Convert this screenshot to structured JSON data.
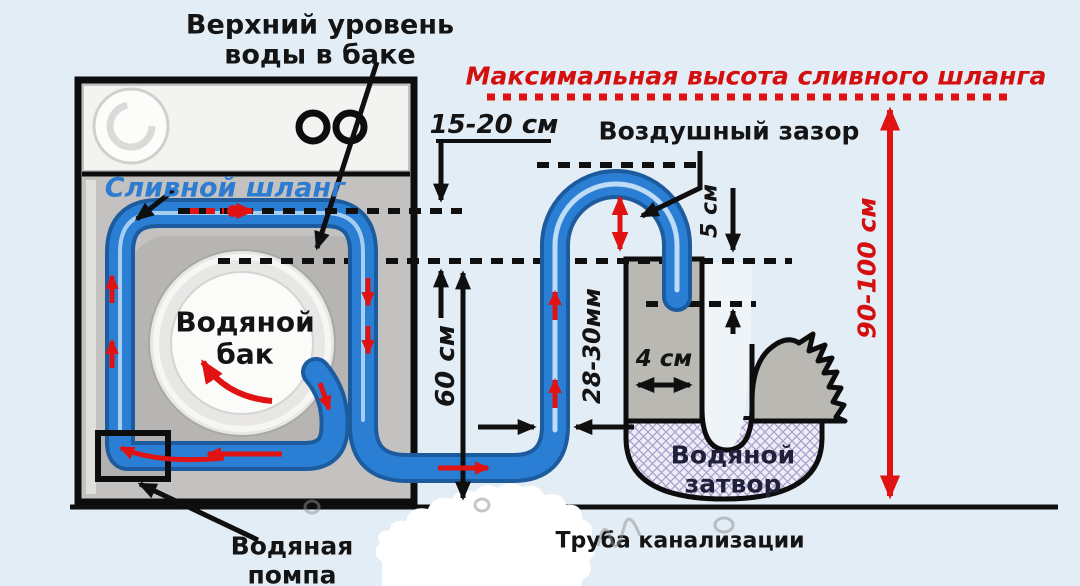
{
  "labels": {
    "upper_water_level": {
      "line1": "Верхний уровень",
      "line2": "воды в баке"
    },
    "max_drain_height": "Максимальная высота сливного шланга",
    "air_gap": "Воздушный зазор",
    "drain_hose": "Сливной шланг",
    "water_tank": {
      "line1": "Водяной",
      "line2": "бак"
    },
    "water_pump": {
      "line1": "Водяная",
      "line2": "помпа"
    },
    "water_seal": {
      "line1": "Водяной",
      "line2": "затвор"
    },
    "sewer_pipe": "Труба канализации"
  },
  "dimensions": {
    "hose_top_offset": "15-20 см",
    "hose_rise_height": "60 см",
    "hose_diameter": "28-30мм",
    "insertion_depth": "5 см",
    "standpipe_width": "4 см",
    "max_height_range": "90-100 см"
  },
  "colors": {
    "background": "#e3edf5",
    "hose_blue": "#2a7fd4",
    "hose_dark": "#1c5c9e",
    "hose_highlight": "#c6e2f8",
    "accent_red": "#e01212",
    "machine_gray": "#c3c2c0",
    "label_blue": "#2d7cd1",
    "ink": "#0f0f0f",
    "seal_text": "#20203a"
  }
}
